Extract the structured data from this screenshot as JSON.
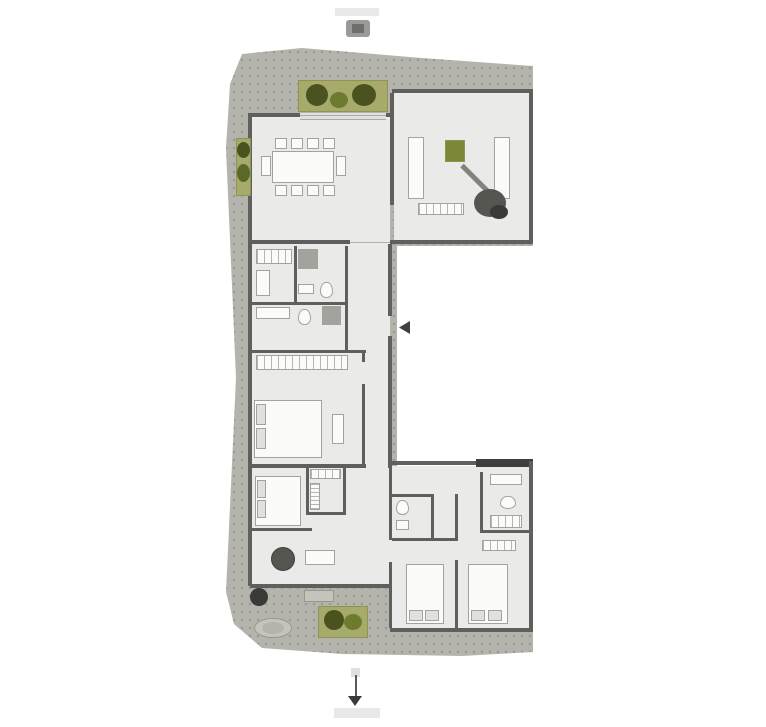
{
  "palette": {
    "canvas": "#ffffff",
    "terrace": "#b4b4ac",
    "floor": "#eaeae8",
    "wall": "#5f5f5d",
    "wallDark": "#3f3f3d",
    "planter": "#a6ab6b",
    "planterEdge": "#8f944f",
    "plantDark": "#4a531f",
    "plantMid": "#5c682a",
    "plantLight": "#6e7a2e",
    "furn": "#fbfbfa",
    "furnLine": "#a2a29e",
    "shade": "#e0e0dc",
    "shower": "#a3a39d",
    "stone": "#c4c4bc",
    "stoneEdge": "#97978f",
    "label": "#e8e8e6",
    "glyph": "#9a9a96",
    "glyphCore": "#6e6e6a",
    "arrow": "#5a5a58",
    "arrowHead": "#3a3a38",
    "olive": "#7e8637",
    "foliageGray": "#565650",
    "stem": "#83837b"
  },
  "plan": {
    "elements": [
      {
        "n": "terrace-deck",
        "c": "terrace-shape tex",
        "x": 222,
        "y": 48,
        "w": 311,
        "h": 610,
        "f": "terrace"
      },
      {
        "n": "floor-dining-room",
        "x": 252,
        "y": 116,
        "w": 138,
        "h": 126,
        "f": "floor"
      },
      {
        "n": "floor-living-room",
        "x": 394,
        "y": 92,
        "w": 136,
        "h": 151,
        "f": "floor"
      },
      {
        "n": "floor-hall-wing",
        "x": 252,
        "y": 243,
        "w": 138,
        "h": 223,
        "f": "floor"
      },
      {
        "n": "floor-bedroom-wing-left",
        "x": 252,
        "y": 466,
        "w": 140,
        "h": 120,
        "f": "floor"
      },
      {
        "n": "floor-bedroom-wing-right",
        "x": 392,
        "y": 466,
        "w": 138,
        "h": 164,
        "f": "floor"
      },
      {
        "n": "wall-living-top",
        "x": 392,
        "y": 89,
        "w": 141,
        "h": 4,
        "f": "wall"
      },
      {
        "n": "wall-living-right",
        "x": 529,
        "y": 89,
        "w": 4,
        "h": 155,
        "f": "wall"
      },
      {
        "n": "wall-topblock-bottom-left",
        "x": 250,
        "y": 240,
        "w": 100,
        "h": 4,
        "f": "wall"
      },
      {
        "n": "wall-topblock-bottom-right",
        "x": 390,
        "y": 240,
        "w": 143,
        "h": 4,
        "f": "wall"
      },
      {
        "n": "wall-dining-top",
        "x": 250,
        "y": 113,
        "w": 142,
        "h": 4,
        "f": "wall"
      },
      {
        "n": "wall-dining-left",
        "x": 248,
        "y": 113,
        "w": 4,
        "h": 131,
        "f": "wall"
      },
      {
        "n": "wall-dining-living-divider",
        "x": 390,
        "y": 93,
        "w": 4,
        "h": 112,
        "f": "wall"
      },
      {
        "n": "wall-wing-left",
        "x": 248,
        "y": 244,
        "w": 4,
        "h": 224,
        "f": "wall"
      },
      {
        "n": "wall-wing-right-upper",
        "x": 388,
        "y": 244,
        "w": 4,
        "h": 72,
        "f": "wall"
      },
      {
        "n": "wall-wing-right-lower",
        "x": 388,
        "y": 336,
        "w": 4,
        "h": 132,
        "f": "wall"
      },
      {
        "n": "wall-bath-h1",
        "x": 250,
        "y": 302,
        "w": 98,
        "h": 3,
        "f": "wall"
      },
      {
        "n": "wall-bath-h2",
        "x": 250,
        "y": 350,
        "w": 116,
        "h": 3,
        "f": "wall"
      },
      {
        "n": "wall-bath-v1",
        "x": 294,
        "y": 246,
        "w": 3,
        "h": 58,
        "f": "wall"
      },
      {
        "n": "wall-corridor-left",
        "x": 345,
        "y": 246,
        "w": 3,
        "h": 106,
        "f": "wall"
      },
      {
        "n": "wall-bedroom1-right-a",
        "x": 362,
        "y": 352,
        "w": 3,
        "h": 10,
        "f": "wall"
      },
      {
        "n": "wall-bedroom1-right-b",
        "x": 362,
        "y": 384,
        "w": 3,
        "h": 82,
        "f": "wall"
      },
      {
        "n": "wall-bottomblock-top-left",
        "x": 250,
        "y": 464,
        "w": 116,
        "h": 4,
        "f": "wall"
      },
      {
        "n": "wall-bottomblock-top-right",
        "x": 390,
        "y": 461,
        "w": 143,
        "h": 4,
        "f": "wall"
      },
      {
        "n": "wall-bottomblock-top-thick",
        "x": 476,
        "y": 459,
        "w": 57,
        "h": 8,
        "f": "wallDark"
      },
      {
        "n": "wall-bottom-right-outer",
        "x": 529,
        "y": 461,
        "w": 4,
        "h": 171,
        "f": "wall"
      },
      {
        "n": "wall-bottom-right-bottom",
        "x": 390,
        "y": 628,
        "w": 143,
        "h": 4,
        "f": "wall"
      },
      {
        "n": "wall-bottom-left-bottom",
        "x": 250,
        "y": 584,
        "w": 142,
        "h": 4,
        "f": "wall"
      },
      {
        "n": "wall-bottom-left-outer",
        "x": 248,
        "y": 466,
        "w": 4,
        "h": 120,
        "f": "wall"
      },
      {
        "n": "wall-wing-divider-a",
        "x": 389,
        "y": 468,
        "w": 3,
        "h": 72,
        "f": "wall"
      },
      {
        "n": "wall-wing-divider-b",
        "x": 389,
        "y": 562,
        "w": 3,
        "h": 66,
        "f": "wall"
      },
      {
        "n": "wall-bath3-top",
        "x": 392,
        "y": 494,
        "w": 42,
        "h": 3,
        "f": "wall"
      },
      {
        "n": "wall-bath3-right",
        "x": 431,
        "y": 494,
        "w": 3,
        "h": 47,
        "f": "wall"
      },
      {
        "n": "wall-bath3-bottom",
        "x": 392,
        "y": 538,
        "w": 66,
        "h": 3,
        "f": "wall"
      },
      {
        "n": "wall-bedrooms-divider-a",
        "x": 455,
        "y": 494,
        "w": 3,
        "h": 46,
        "f": "wall"
      },
      {
        "n": "wall-bedrooms-divider-b",
        "x": 455,
        "y": 560,
        "w": 3,
        "h": 68,
        "f": "wall"
      },
      {
        "n": "wall-bath4-left",
        "x": 480,
        "y": 472,
        "w": 3,
        "h": 60,
        "f": "wall"
      },
      {
        "n": "wall-bath4-bottom",
        "x": 480,
        "y": 530,
        "w": 53,
        "h": 3,
        "f": "wall"
      },
      {
        "n": "wall-closet-v1",
        "x": 306,
        "y": 466,
        "w": 3,
        "h": 48,
        "f": "wall"
      },
      {
        "n": "wall-closet-v2",
        "x": 343,
        "y": 466,
        "w": 3,
        "h": 48,
        "f": "wall"
      },
      {
        "n": "wall-closet-h",
        "x": 306,
        "y": 512,
        "w": 40,
        "h": 3,
        "f": "wall"
      },
      {
        "n": "wall-bed2-foot",
        "x": 250,
        "y": 528,
        "w": 62,
        "h": 3,
        "f": "wall"
      },
      {
        "n": "entry-door-leaf",
        "c": "tri-left",
        "x": 399,
        "y": 321,
        "w": 11,
        "h": 13,
        "f": "wallDark"
      },
      {
        "n": "dining-table",
        "x": 272,
        "y": 151,
        "w": 62,
        "h": 32,
        "f": "furn",
        "s": "furnLine"
      },
      {
        "n": "dining-chair-1",
        "x": 275,
        "y": 138,
        "w": 12,
        "h": 11,
        "f": "furn",
        "s": "furnLine"
      },
      {
        "n": "dining-chair-2",
        "x": 291,
        "y": 138,
        "w": 12,
        "h": 11,
        "f": "furn",
        "s": "furnLine"
      },
      {
        "n": "dining-chair-3",
        "x": 307,
        "y": 138,
        "w": 12,
        "h": 11,
        "f": "furn",
        "s": "furnLine"
      },
      {
        "n": "dining-chair-4",
        "x": 323,
        "y": 138,
        "w": 12,
        "h": 11,
        "f": "furn",
        "s": "furnLine"
      },
      {
        "n": "dining-chair-5",
        "x": 275,
        "y": 185,
        "w": 12,
        "h": 11,
        "f": "furn",
        "s": "furnLine"
      },
      {
        "n": "dining-chair-6",
        "x": 291,
        "y": 185,
        "w": 12,
        "h": 11,
        "f": "furn",
        "s": "furnLine"
      },
      {
        "n": "dining-chair-7",
        "x": 307,
        "y": 185,
        "w": 12,
        "h": 11,
        "f": "furn",
        "s": "furnLine"
      },
      {
        "n": "dining-chair-8",
        "x": 323,
        "y": 185,
        "w": 12,
        "h": 11,
        "f": "furn",
        "s": "furnLine"
      },
      {
        "n": "dining-chair-end-left",
        "x": 261,
        "y": 156,
        "w": 10,
        "h": 20,
        "f": "furn",
        "s": "furnLine"
      },
      {
        "n": "dining-chair-end-right",
        "x": 336,
        "y": 156,
        "w": 10,
        "h": 20,
        "f": "furn",
        "s": "furnLine"
      },
      {
        "n": "sofa-left",
        "x": 408,
        "y": 137,
        "w": 16,
        "h": 62,
        "f": "furn",
        "s": "furnLine"
      },
      {
        "n": "sofa-right",
        "x": 494,
        "y": 137,
        "w": 16,
        "h": 62,
        "f": "furn",
        "s": "furnLine"
      },
      {
        "n": "coffee-table",
        "x": 445,
        "y": 140,
        "w": 20,
        "h": 22,
        "f": "olive",
        "s": "planterEdge"
      },
      {
        "n": "plant-stem",
        "c": "rot45",
        "x": 462,
        "y": 163,
        "w": 40,
        "h": 5,
        "f": "stem"
      },
      {
        "n": "plant-foliage-large",
        "c": "ellipse",
        "x": 474,
        "y": 189,
        "w": 32,
        "h": 28,
        "f": "foliageGray"
      },
      {
        "n": "plant-foliage-small",
        "c": "ellipse",
        "x": 490,
        "y": 205,
        "w": 18,
        "h": 14,
        "f": "arrowHead"
      },
      {
        "n": "tv-bench",
        "c": "stripes",
        "x": 418,
        "y": 203,
        "w": 46,
        "h": 12,
        "f": "furn",
        "s": "furnLine"
      },
      {
        "n": "closet-room-a",
        "c": "stripes",
        "x": 256,
        "y": 249,
        "w": 36,
        "h": 15,
        "f": "furn",
        "s": "furnLine"
      },
      {
        "n": "cabinet-room-a",
        "x": 256,
        "y": 270,
        "w": 14,
        "h": 26,
        "f": "furn",
        "s": "furnLine"
      },
      {
        "n": "shower-room-b",
        "x": 298,
        "y": 249,
        "w": 20,
        "h": 20,
        "f": "shower",
        "s": "furnLine"
      },
      {
        "n": "toilet-room-b",
        "c": "wc",
        "x": 320,
        "y": 282,
        "w": 13,
        "h": 16,
        "f": "furn",
        "s": "furnLine"
      },
      {
        "n": "sink-room-b",
        "x": 298,
        "y": 284,
        "w": 16,
        "h": 10,
        "f": "furn",
        "s": "furnLine"
      },
      {
        "n": "vanity-room-c",
        "x": 256,
        "y": 307,
        "w": 34,
        "h": 12,
        "f": "furn",
        "s": "furnLine"
      },
      {
        "n": "toilet-room-c",
        "c": "wc",
        "x": 298,
        "y": 309,
        "w": 13,
        "h": 16,
        "f": "furn",
        "s": "furnLine"
      },
      {
        "n": "shower-room-c",
        "x": 322,
        "y": 306,
        "w": 19,
        "h": 19,
        "f": "shower",
        "s": "furnLine"
      },
      {
        "n": "wardrobe-bedroom-1",
        "c": "stripes",
        "x": 256,
        "y": 355,
        "w": 92,
        "h": 15,
        "f": "furn",
        "s": "furnLine"
      },
      {
        "n": "bed-1",
        "x": 254,
        "y": 400,
        "w": 68,
        "h": 58,
        "f": "furn",
        "s": "furnLine"
      },
      {
        "n": "bed-1-pillow-a",
        "x": 256,
        "y": 404,
        "w": 10,
        "h": 21,
        "f": "shade",
        "s": "furnLine"
      },
      {
        "n": "bed-1-pillow-b",
        "x": 256,
        "y": 428,
        "w": 10,
        "h": 21,
        "f": "shade",
        "s": "furnLine"
      },
      {
        "n": "bench-bedroom-1",
        "x": 332,
        "y": 414,
        "w": 12,
        "h": 30,
        "f": "furn",
        "s": "furnLine"
      },
      {
        "n": "bed-2",
        "x": 255,
        "y": 476,
        "w": 46,
        "h": 50,
        "f": "furn",
        "s": "furnLine"
      },
      {
        "n": "bed-2-pillow-a",
        "x": 257,
        "y": 480,
        "w": 9,
        "h": 18,
        "f": "shade",
        "s": "furnLine"
      },
      {
        "n": "bed-2-pillow-b",
        "x": 257,
        "y": 500,
        "w": 9,
        "h": 18,
        "f": "shade",
        "s": "furnLine"
      },
      {
        "n": "closet-shelf-a",
        "c": "stripes",
        "x": 310,
        "y": 469,
        "w": 31,
        "h": 10,
        "f": "furn",
        "s": "furnLine"
      },
      {
        "n": "closet-shelf-b",
        "c": "stripes-h",
        "x": 310,
        "y": 483,
        "w": 10,
        "h": 27,
        "f": "furn",
        "s": "furnLine"
      },
      {
        "n": "armchair-round",
        "c": "ellipse",
        "x": 271,
        "y": 547,
        "w": 24,
        "h": 24,
        "f": "foliageGray",
        "s": "wallDark"
      },
      {
        "n": "side-table",
        "x": 305,
        "y": 550,
        "w": 30,
        "h": 15,
        "f": "furn",
        "s": "furnLine"
      },
      {
        "n": "toilet-bath-3",
        "c": "wc",
        "x": 396,
        "y": 500,
        "w": 13,
        "h": 15,
        "f": "furn",
        "s": "furnLine"
      },
      {
        "n": "sink-bath-3",
        "x": 396,
        "y": 520,
        "w": 13,
        "h": 10,
        "f": "furn",
        "s": "furnLine"
      },
      {
        "n": "vanity-bath-4",
        "x": 490,
        "y": 474,
        "w": 32,
        "h": 11,
        "f": "furn",
        "s": "furnLine"
      },
      {
        "n": "toilet-bath-4",
        "c": "wc",
        "x": 500,
        "y": 496,
        "w": 16,
        "h": 13,
        "f": "furn",
        "s": "furnLine"
      },
      {
        "n": "shelf-bath-4",
        "c": "stripes",
        "x": 490,
        "y": 515,
        "w": 32,
        "h": 13,
        "f": "furn",
        "s": "furnLine"
      },
      {
        "n": "bed-3",
        "x": 406,
        "y": 564,
        "w": 38,
        "h": 60,
        "f": "furn",
        "s": "furnLine"
      },
      {
        "n": "bed-3-pillow-a",
        "x": 409,
        "y": 610,
        "w": 14,
        "h": 11,
        "f": "shade",
        "s": "furnLine"
      },
      {
        "n": "bed-3-pillow-b",
        "x": 425,
        "y": 610,
        "w": 14,
        "h": 11,
        "f": "shade",
        "s": "furnLine"
      },
      {
        "n": "bed-4",
        "x": 468,
        "y": 564,
        "w": 40,
        "h": 60,
        "f": "furn",
        "s": "furnLine"
      },
      {
        "n": "bed-4-pillow-a",
        "x": 471,
        "y": 610,
        "w": 14,
        "h": 11,
        "f": "shade",
        "s": "furnLine"
      },
      {
        "n": "bed-4-pillow-b",
        "x": 488,
        "y": 610,
        "w": 14,
        "h": 11,
        "f": "shade",
        "s": "furnLine"
      },
      {
        "n": "wardrobe-bedroom-4",
        "c": "stripes",
        "x": 482,
        "y": 540,
        "w": 34,
        "h": 11,
        "f": "furn",
        "s": "furnLine"
      },
      {
        "n": "planter-top",
        "x": 298,
        "y": 80,
        "w": 90,
        "h": 32,
        "f": "planter",
        "s": "planterEdge"
      },
      {
        "n": "plant-top-1",
        "c": "ellipse",
        "x": 306,
        "y": 84,
        "w": 22,
        "h": 22,
        "f": "plantDark"
      },
      {
        "n": "plant-top-2",
        "c": "ellipse",
        "x": 330,
        "y": 92,
        "w": 18,
        "h": 16,
        "f": "plantLight"
      },
      {
        "n": "plant-top-3",
        "c": "ellipse",
        "x": 352,
        "y": 84,
        "w": 24,
        "h": 22,
        "f": "plantDark"
      },
      {
        "n": "terrace-steps",
        "c": "stripes-h",
        "x": 300,
        "y": 113,
        "w": 86,
        "h": 7,
        "f": "shade"
      },
      {
        "n": "planter-left",
        "x": 236,
        "y": 138,
        "w": 15,
        "h": 58,
        "f": "planter",
        "s": "planterEdge"
      },
      {
        "n": "plant-left-1",
        "c": "ellipse",
        "x": 237,
        "y": 142,
        "w": 13,
        "h": 16,
        "f": "plantDark"
      },
      {
        "n": "plant-left-2",
        "c": "ellipse",
        "x": 237,
        "y": 164,
        "w": 13,
        "h": 18,
        "f": "plantMid"
      },
      {
        "n": "planter-bottom",
        "x": 318,
        "y": 606,
        "w": 50,
        "h": 32,
        "f": "planter",
        "s": "planterEdge"
      },
      {
        "n": "plant-bottom-1",
        "c": "ellipse",
        "x": 324,
        "y": 610,
        "w": 20,
        "h": 20,
        "f": "plantDark"
      },
      {
        "n": "plant-bottom-2",
        "c": "ellipse",
        "x": 344,
        "y": 614,
        "w": 18,
        "h": 16,
        "f": "plantLight"
      },
      {
        "n": "terrace-oval-ornament",
        "c": "ellipse",
        "x": 254,
        "y": 618,
        "w": 38,
        "h": 20,
        "f": "stone",
        "s": "stoneEdge"
      },
      {
        "n": "terrace-oval-inner",
        "c": "ellipse",
        "x": 262,
        "y": 622,
        "w": 22,
        "h": 12,
        "f": "terrace"
      },
      {
        "n": "outdoor-bench",
        "x": 304,
        "y": 590,
        "w": 30,
        "h": 12,
        "f": "stone",
        "s": "stoneEdge"
      },
      {
        "n": "outdoor-plant-corner",
        "c": "ellipse",
        "x": 250,
        "y": 588,
        "w": 18,
        "h": 18,
        "f": "arrowHead"
      },
      {
        "n": "top-caption-bar",
        "x": 335,
        "y": 8,
        "w": 44,
        "h": 8,
        "f": "label"
      },
      {
        "n": "top-entry-glyph",
        "c": "roundxs",
        "x": 346,
        "y": 20,
        "w": 24,
        "h": 17,
        "f": "glyph"
      },
      {
        "n": "top-entry-glyph-core",
        "x": 352,
        "y": 24,
        "w": 12,
        "h": 9,
        "f": "glyphCore"
      },
      {
        "n": "bottom-arrow-base",
        "x": 351,
        "y": 668,
        "w": 9,
        "h": 9,
        "f": "shade"
      },
      {
        "n": "bottom-arrow-line",
        "x": 355,
        "y": 675,
        "w": 2,
        "h": 23,
        "f": "arrow"
      },
      {
        "n": "bottom-arrow-head",
        "c": "tri-down",
        "x": 348,
        "y": 696,
        "w": 14,
        "h": 10,
        "f": "arrowHead"
      },
      {
        "n": "bottom-caption-bar",
        "x": 334,
        "y": 708,
        "w": 46,
        "h": 10,
        "f": "label"
      }
    ]
  }
}
